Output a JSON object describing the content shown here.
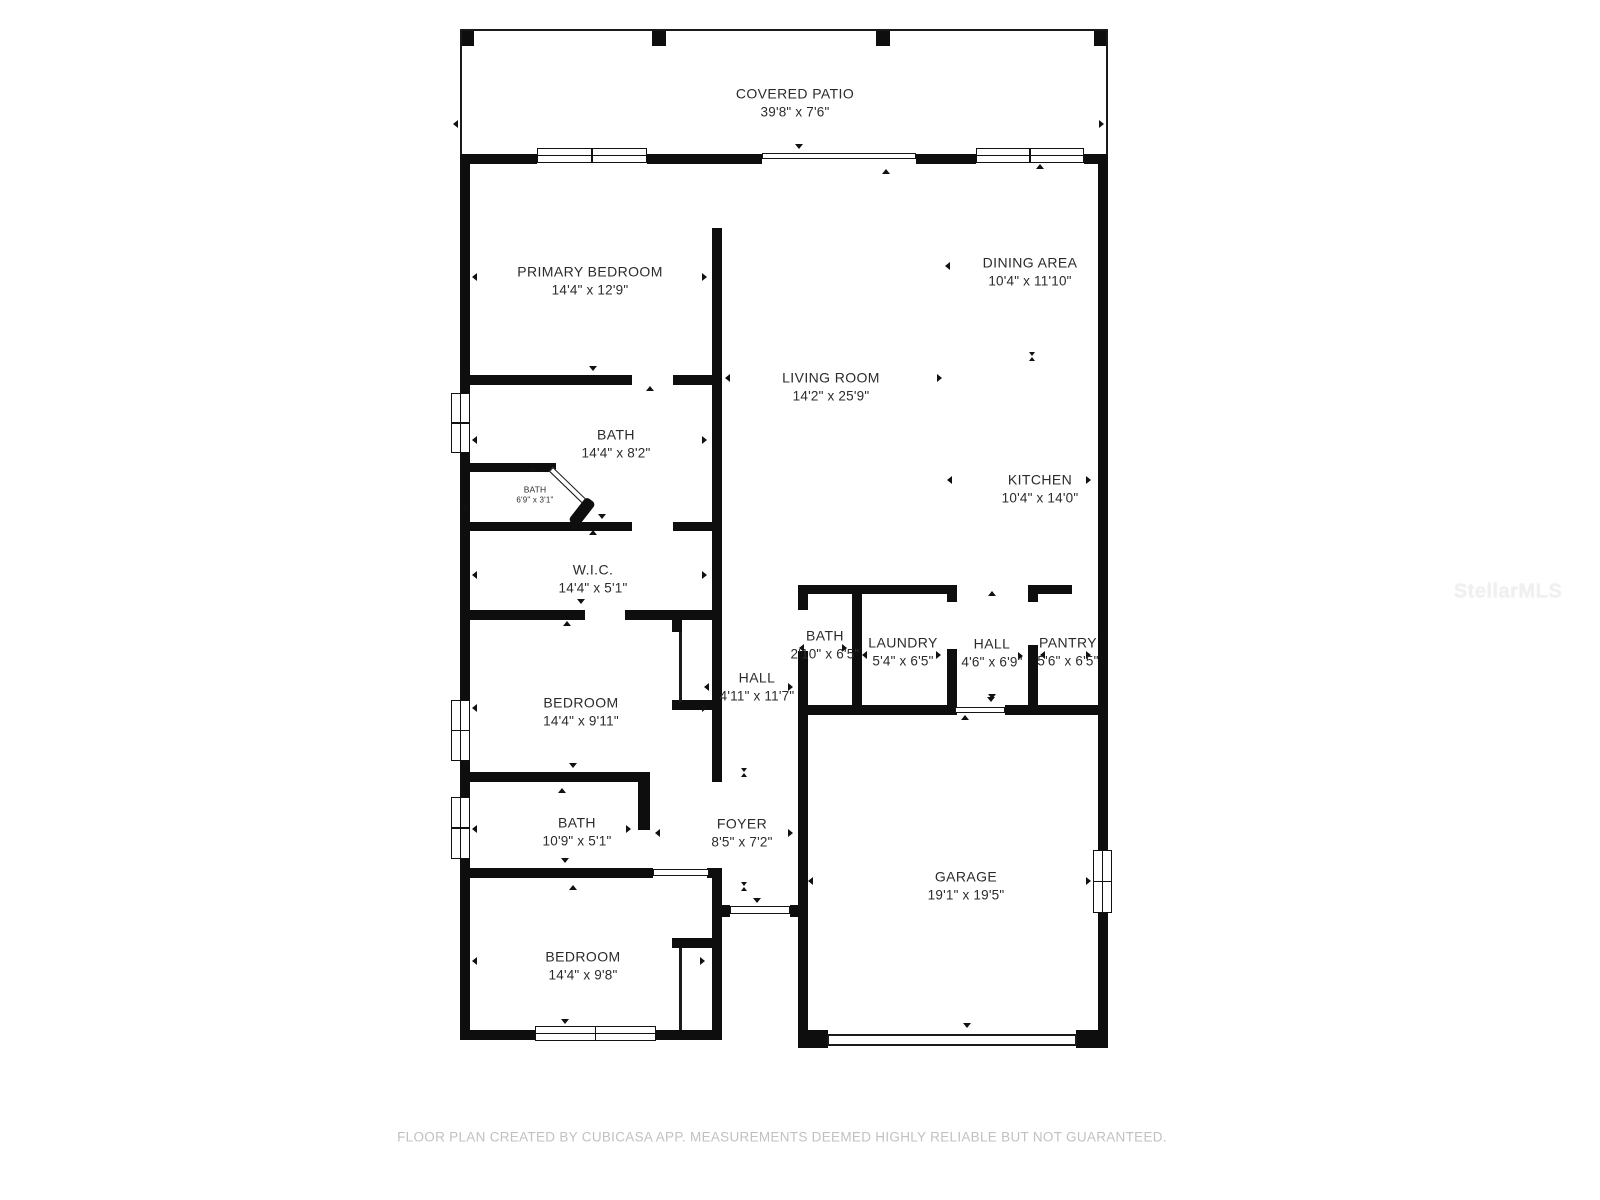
{
  "watermark": "StellarMLS",
  "footer": {
    "disclaimer": "FLOOR PLAN CREATED BY CUBICASA APP. MEASUREMENTS DEEMED HIGHLY RELIABLE BUT NOT GUARANTEED."
  },
  "rooms": {
    "covered_patio": {
      "name": "COVERED PATIO",
      "dims": "39'8\" x 7'6\""
    },
    "primary_bedroom": {
      "name": "PRIMARY BEDROOM",
      "dims": "14'4\" x 12'9\""
    },
    "primary_bath": {
      "name": "BATH",
      "dims": "14'4\" x 8'2\""
    },
    "water_closet": {
      "name": "BATH",
      "dims": "6'9\" x 3'1\""
    },
    "wic": {
      "name": "W.I.C.",
      "dims": "14'4\" x 5'1\""
    },
    "bedroom_middle": {
      "name": "BEDROOM",
      "dims": "14'4\" x 9'11\""
    },
    "hall_long": {
      "name": "HALL",
      "dims": "4'11\" x 11'7\""
    },
    "bath_hall": {
      "name": "BATH",
      "dims": "2'10\" x 6'5\""
    },
    "laundry": {
      "name": "LAUNDRY",
      "dims": "5'4\" x 6'5\""
    },
    "hall_small": {
      "name": "HALL",
      "dims": "4'6\" x 6'9\""
    },
    "pantry": {
      "name": "PANTRY",
      "dims": "5'6\" x 6'5\""
    },
    "bath_guest": {
      "name": "BATH",
      "dims": "10'9\" x 5'1\""
    },
    "foyer": {
      "name": "FOYER",
      "dims": "8'5\" x 7'2\""
    },
    "bedroom_bottom": {
      "name": "BEDROOM",
      "dims": "14'4\" x 9'8\""
    },
    "living_room": {
      "name": "LIVING ROOM",
      "dims": "14'2\" x 25'9\""
    },
    "dining_area": {
      "name": "DINING AREA",
      "dims": "10'4\" x 11'10\""
    },
    "kitchen": {
      "name": "KITCHEN",
      "dims": "10'4\" x 14'0\""
    },
    "garage": {
      "name": "GARAGE",
      "dims": "19'1\" x 19'5\""
    }
  },
  "colors": {
    "wall": "#0e0e0e",
    "label": "#2b2b2b",
    "footer": "#c1c1c1",
    "watermark": "#f0f0f0"
  }
}
